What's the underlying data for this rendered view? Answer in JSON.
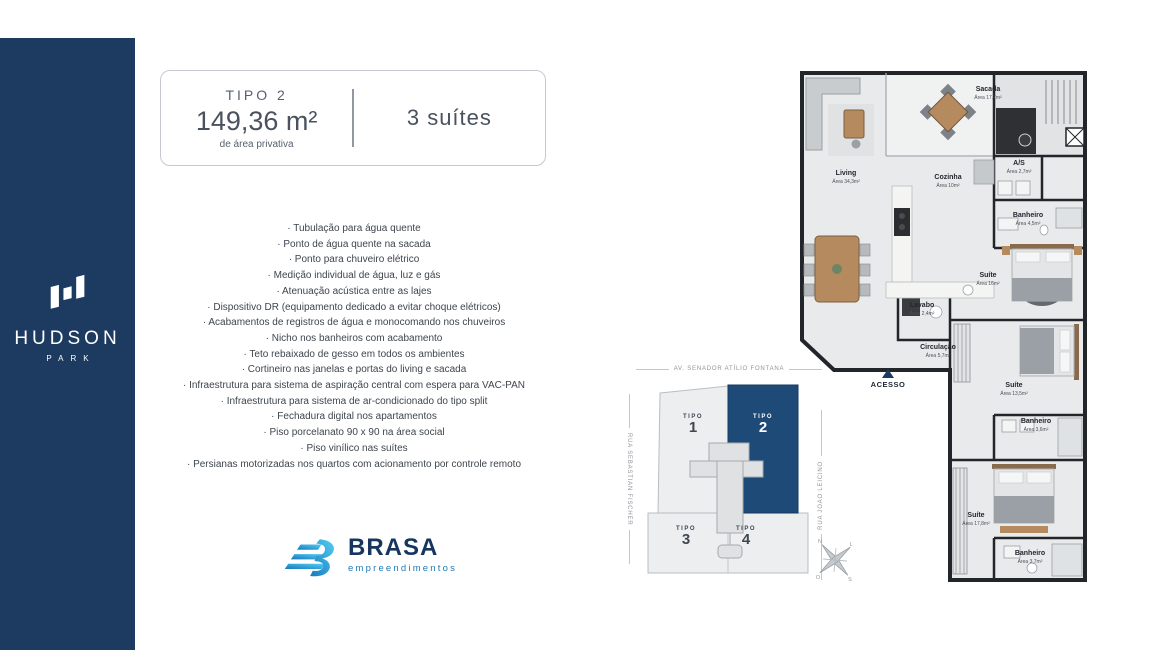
{
  "sidebar": {
    "logo_name": "HUDSON",
    "logo_sub": "PARK"
  },
  "title_card": {
    "type_label": "TIPO 2",
    "area_value": "149,36 m²",
    "area_caption": "de área privativa",
    "suites_label": "3 suítes"
  },
  "features": [
    "· Tubulação para água quente",
    "· Ponto de água quente na sacada",
    "· Ponto para chuveiro elétrico",
    "· Medição individual de água, luz e gás",
    "· Atenuação acústica entre as lajes",
    "· Dispositivo DR (equipamento dedicado a evitar choque elétricos)",
    "· Acabamentos de registros de água e monocomando nos chuveiros",
    "· Nicho nos banheiros com acabamento",
    "· Teto rebaixado de gesso em todos os ambientes",
    "· Cortineiro nas janelas e portas do living e sacada",
    "· Infraestrutura para sistema de aspiração central com espera para VAC-PAN",
    "· Infraestrutura para sistema de ar-condicionado do tipo split",
    "· Fechadura digital nos apartamentos",
    "· Piso porcelanato 90 x 90 na área social",
    "· Piso vinílico nas suítes",
    "· Persianas motorizadas nos quartos com acionamento por controle remoto"
  ],
  "developer": {
    "name": "BRASA",
    "tagline": "empreendimentos"
  },
  "siteplan": {
    "street_top": "AV. SENADOR ATÍLIO FONTANA",
    "street_left": "RUA SEBASTIAN FISCHER",
    "street_right": "RUA JOÃO LEICINO",
    "units": [
      {
        "label": "TIPO",
        "number": "1",
        "highlighted": false
      },
      {
        "label": "TIPO",
        "number": "2",
        "highlighted": true
      },
      {
        "label": "TIPO",
        "number": "3",
        "highlighted": false
      },
      {
        "label": "TIPO",
        "number": "4",
        "highlighted": false
      }
    ],
    "compass": {
      "n": "N",
      "e": "L",
      "s": "S",
      "w": "O"
    }
  },
  "floorplan": {
    "access_label": "ACESSO",
    "rooms": [
      {
        "name": "Sacada",
        "area": "Área 17,7m²",
        "x": 190,
        "y": 18
      },
      {
        "name": "Living",
        "area": "Área 34,3m²",
        "x": 48,
        "y": 102
      },
      {
        "name": "Cozinha",
        "area": "Área 10m²",
        "x": 150,
        "y": 106
      },
      {
        "name": "A/S",
        "area": "Área 2,7m²",
        "x": 221,
        "y": 92
      },
      {
        "name": "Banheiro",
        "area": "Área 4,5m²",
        "x": 230,
        "y": 144
      },
      {
        "name": "Suíte",
        "area": "Área 16m²",
        "x": 190,
        "y": 204
      },
      {
        "name": "Lavabo",
        "area": "Área 2,4m²",
        "x": 124,
        "y": 234
      },
      {
        "name": "Circulação",
        "area": "Área 5,7m²",
        "x": 140,
        "y": 276
      },
      {
        "name": "Suíte",
        "area": "Área 13,5m²",
        "x": 216,
        "y": 314
      },
      {
        "name": "Banheiro",
        "area": "Área 3,6m²",
        "x": 238,
        "y": 350
      },
      {
        "name": "Suíte",
        "area": "Área 17,8m²",
        "x": 178,
        "y": 444
      },
      {
        "name": "Banheiro",
        "area": "Área 3,7m²",
        "x": 232,
        "y": 482
      }
    ]
  },
  "colors": {
    "navy": "#1d3b60",
    "keyplan_highlight": "#1e4a77",
    "brand_blue": "#1779be",
    "brand_cyan": "#54cdf2"
  }
}
